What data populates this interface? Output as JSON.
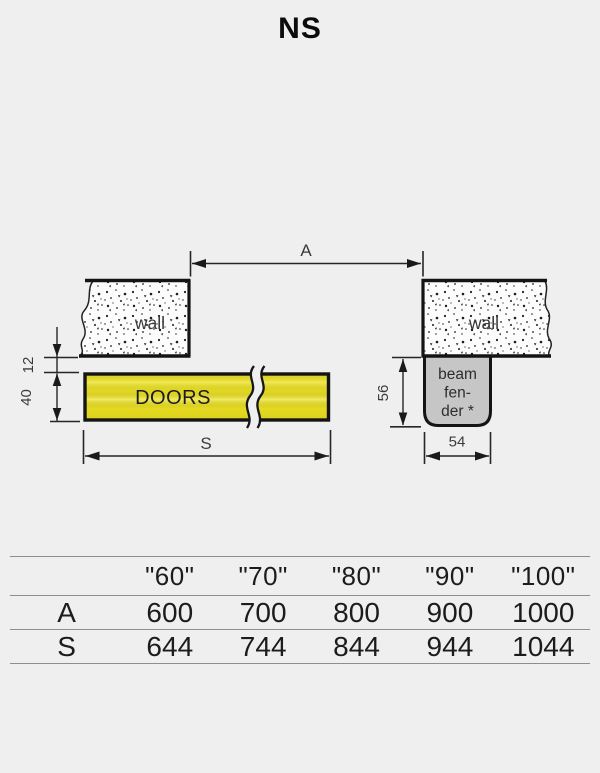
{
  "title": "NS",
  "diagram": {
    "dim_a_label": "A",
    "dim_s_label": "S",
    "wall_left_label": "wall",
    "wall_right_label": "wall",
    "doors_label": "DOORS",
    "beam_fender_label": {
      "line1": "beam",
      "line2": "fen-",
      "line3": "der *"
    },
    "dim_gap": "12",
    "dim_door_thickness": "40",
    "dim_fender_height": "56",
    "dim_fender_width": "54",
    "colors": {
      "doors_yellow": "#eee321",
      "fender_gray": "#c6c6c6",
      "wall_fill": "#fcfcfc",
      "line_black": "#1a1a1a"
    }
  },
  "table": {
    "size_headers": [
      "\"60\"",
      "\"70\"",
      "\"80\"",
      "\"90\"",
      "\"100\""
    ],
    "rows": [
      {
        "label": "A",
        "values": [
          "600",
          "700",
          "800",
          "900",
          "1000"
        ]
      },
      {
        "label": "S",
        "values": [
          "644",
          "744",
          "844",
          "944",
          "1044"
        ]
      }
    ]
  }
}
